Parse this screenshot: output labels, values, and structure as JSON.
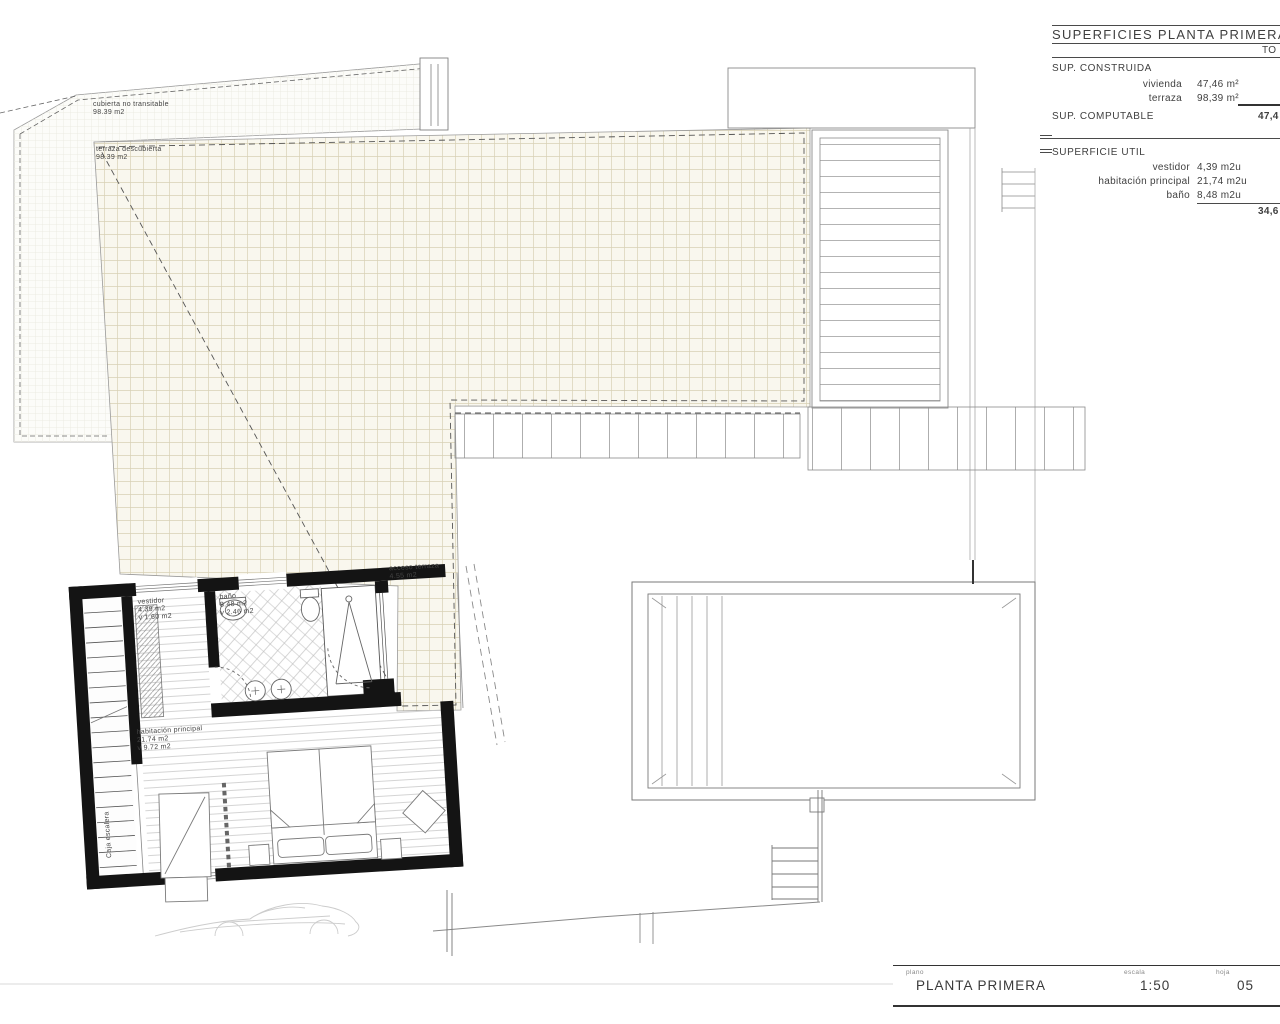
{
  "drawing": {
    "labels": {
      "cubierta": {
        "line1": "cubierta no transitable",
        "line2": "98.39 m2"
      },
      "terraza": {
        "line1": "terraza descubierta",
        "line2": "98.39 m2"
      },
      "acceso": {
        "line1": "acceso terraza",
        "line2": "4.55 m2"
      },
      "vestidor": {
        "line1": "vestidor",
        "line2": "4.39 m2",
        "line3": "v 1.60 m2"
      },
      "bano": {
        "line1": "baño",
        "line2": "8.48 m2",
        "line3": "v 2.46 m2"
      },
      "habitacion": {
        "line1": "habitación principal",
        "line2": "21.74 m2",
        "line3": "v 9.72 m2"
      },
      "caja_escalera": "Caja escalera"
    }
  },
  "surfaces_table": {
    "title": "SUPERFICIES PLANTA PRIMERA",
    "total_header_clipped": "TO",
    "sup_construida": {
      "label": "SUP. CONSTRUIDA",
      "rows": [
        {
          "name": "vivienda",
          "value": "47,46 m²"
        },
        {
          "name": "terraza",
          "value": "98,39 m²"
        }
      ]
    },
    "sup_computable": {
      "label": "SUP. COMPUTABLE",
      "total_clipped": "47,4"
    },
    "superficie_util": {
      "label": "SUPERFICIE UTIL",
      "rows": [
        {
          "name": "vestidor",
          "value": "4,39 m2u"
        },
        {
          "name": "habitación principal",
          "value": "21,74 m2u"
        },
        {
          "name": "baño",
          "value": "8,48 m2u"
        }
      ],
      "total_clipped": "34,6"
    }
  },
  "title_block": {
    "plano_label": "plano",
    "plano_value": "PLANTA PRIMERA",
    "escala_label": "escala",
    "escala_value": "1:50",
    "hoja_label": "hoja",
    "hoja_value": "05"
  },
  "colors": {
    "tile_line": "#d8d1b5",
    "terrace_fill": "#f9f7ee",
    "wall_black": "#141414",
    "line_dark": "#4a4a4a",
    "line_mid": "#8a8a8a",
    "line_faint": "#cccccc"
  }
}
